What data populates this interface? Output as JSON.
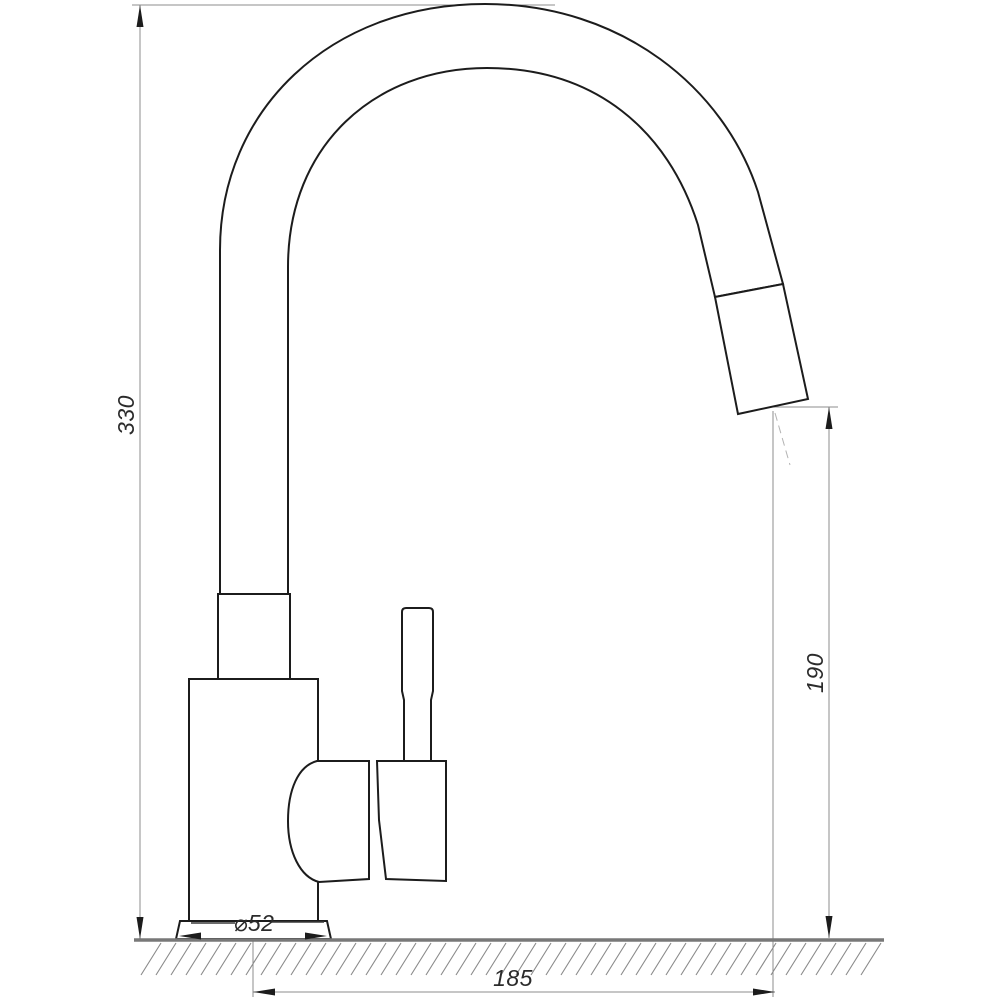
{
  "drawing": {
    "type": "faucet-dimension-drawing",
    "view": "side",
    "background_color": "#ffffff",
    "outline_color": "#1c1c1c",
    "dimension_line_color": "#8c8c8c",
    "text_color": "#2b2b2b",
    "labels": {
      "overall_height": "330",
      "spout_outlet_height": "190",
      "spout_reach": "185",
      "base_diameter": "⌀52"
    }
  }
}
